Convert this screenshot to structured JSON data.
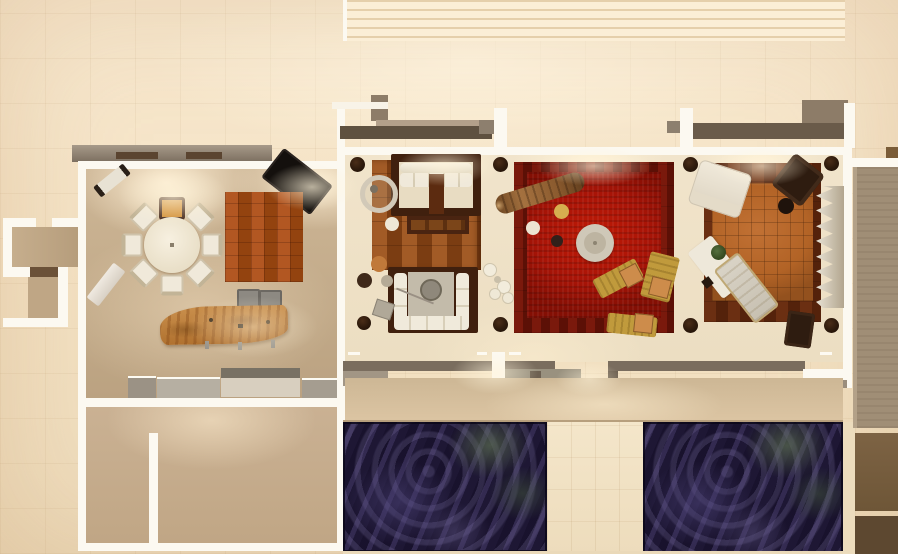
{
  "scene": {
    "kind": "architectural-floorplan-3d-render",
    "view": "top-down",
    "note": "photorealistic top view of a residence with three furnished lounges, dining-kitchen wing, terrace and two dark water pools; no visible text in image"
  },
  "palette": {
    "wall": "#fcf9f1",
    "grayWallDark": "#5f5140",
    "grayWall": "#7a6d5e",
    "grayWallLight": "#a29685",
    "floorTan": "#c6ae8d",
    "floorCream": "#efe2c9",
    "parquetA": "#a25b26",
    "parquetB": "#7b3d12",
    "redWoodA": "#7a190c",
    "redWoodB": "#5c1006",
    "redRug": "#a81407",
    "rightWoodA": "#6b2f12",
    "rightWoodB": "#54220b",
    "rightRug": "#b26326",
    "checkA": "#b25722",
    "checkB": "#93430f",
    "poolBase": "#251d3d",
    "terrace": "#d2bb9a",
    "cushion": "#f0e9da",
    "sofaFrame": "#40200e",
    "darkFurn": "#2e1c10",
    "chaiseYellow": "#c09a3c",
    "chaiseCushion": "#cd8c4b",
    "logBrown": "#8a5a2e",
    "slabWood": "#c08445",
    "grayFloor": "#a08e76",
    "brownTileA": "#6e5637",
    "brownTileB": "#5d4830",
    "piano": "#14100d",
    "cabinet": "#b6afa2"
  },
  "rooms": [
    {
      "name": "stairs-top",
      "furniture": [
        "stair-treads"
      ]
    },
    {
      "name": "dining-kitchen",
      "furniture": [
        "round-dining-table",
        "dining-chair x7",
        "high-chair",
        "grand-piano",
        "checkered-rug",
        "wood-slab-counter",
        "bar-chair x2",
        "sideboard-cabinets",
        "entry-bench",
        "light-bench"
      ]
    },
    {
      "name": "entry-alcove",
      "furniture": []
    },
    {
      "name": "lower-annex-rooms",
      "furniture": []
    },
    {
      "name": "parquet-lounge",
      "furniture": [
        "wood-frame-sofa",
        "coffee-table",
        "daybed-sofa",
        "ring-chair",
        "pouf x4",
        "glass-set",
        "corner-planters"
      ]
    },
    {
      "name": "red-lounge",
      "furniture": [
        "log-bench",
        "round-ring-table",
        "pouf x3",
        "chaise-longue x3",
        "corner-planters"
      ]
    },
    {
      "name": "family-room",
      "furniture": [
        "white-sofa",
        "dark-armchair",
        "round-side-table",
        "zigzag-screen",
        "coffee-table-with-plant",
        "gray-chaise",
        "dark-ottoman",
        "corner-planters"
      ]
    },
    {
      "name": "pool-terrace",
      "furniture": [
        "pool-left",
        "pool-right",
        "middle-deck"
      ]
    },
    {
      "name": "right-service-strip",
      "furniture": [
        "gray-floor",
        "brown-tiles"
      ]
    }
  ]
}
